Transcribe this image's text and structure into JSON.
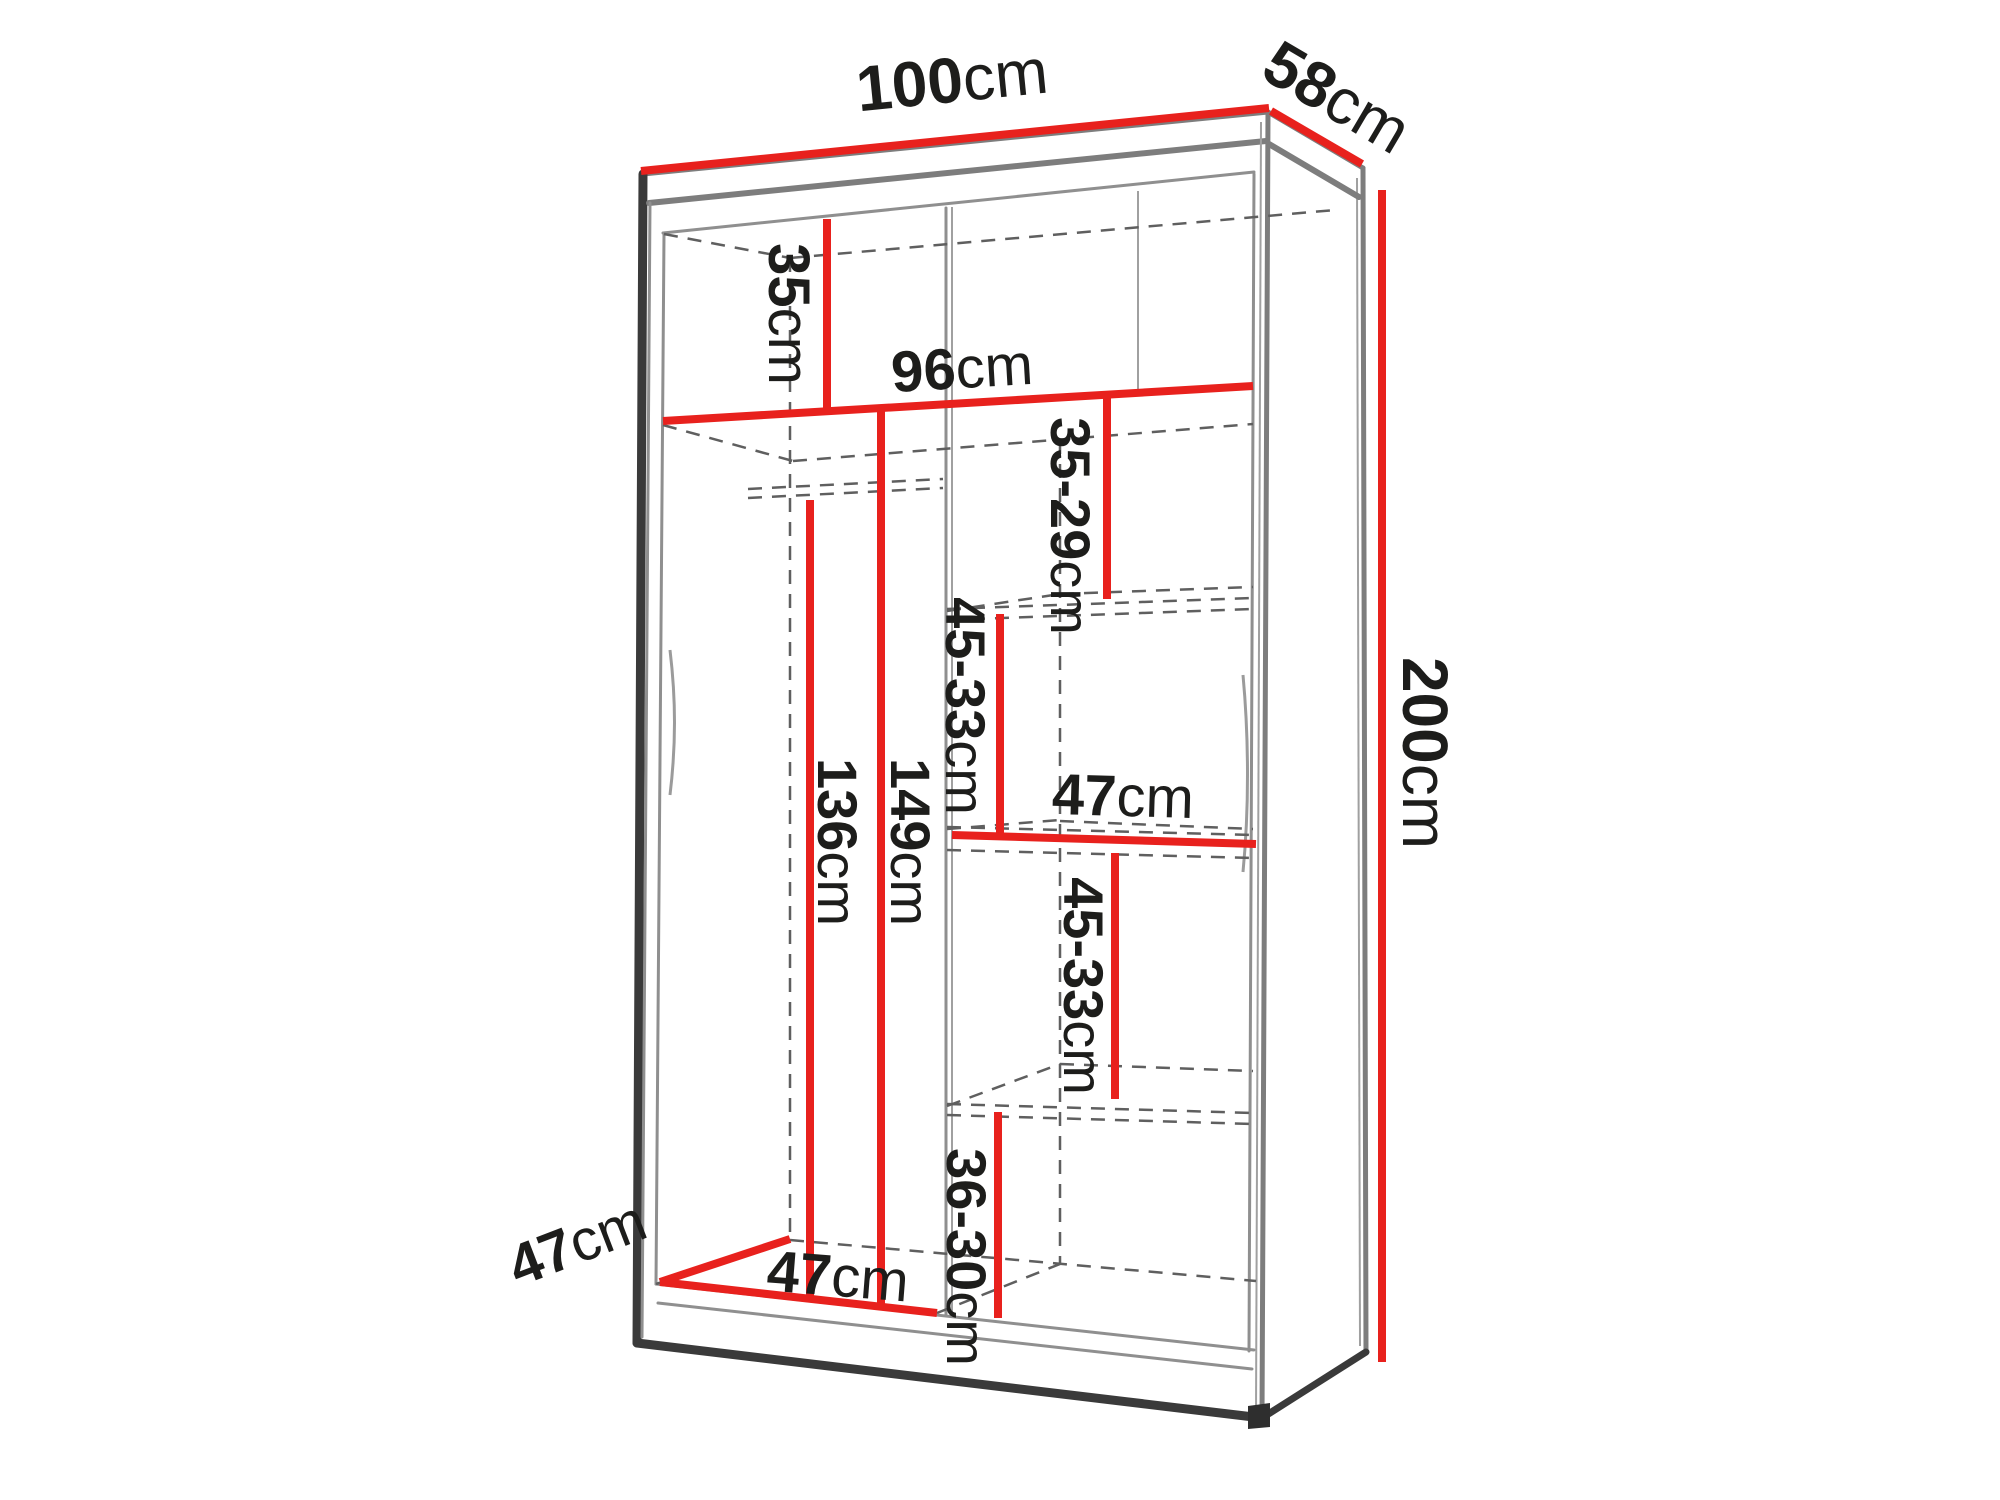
{
  "colors": {
    "dimension_red": "#e8211d",
    "line_dark": "#3a3a3a",
    "line_gray": "#7d7d7d",
    "text_dark": "#1d1d1b",
    "background": "#ffffff"
  },
  "dimensions": {
    "overall_width": {
      "value": "100",
      "unit": "cm"
    },
    "overall_depth": {
      "value": "58",
      "unit": "cm"
    },
    "overall_height": {
      "value": "200",
      "unit": "cm"
    },
    "top_compartment_height": {
      "value": "35",
      "unit": "cm"
    },
    "interior_width": {
      "value": "96",
      "unit": "cm"
    },
    "gap_top_right": {
      "value": "35-29",
      "unit": "cm"
    },
    "gap_upper_right": {
      "value": "45-33",
      "unit": "cm"
    },
    "shelf_width_right": {
      "value": "47",
      "unit": "cm"
    },
    "gap_lower_right": {
      "value": "45-33",
      "unit": "cm"
    },
    "gap_bottom_right": {
      "value": "36-30",
      "unit": "cm"
    },
    "hanging_space_height": {
      "value": "136",
      "unit": "cm"
    },
    "left_section_height": {
      "value": "149",
      "unit": "cm"
    },
    "interior_depth": {
      "value": "47",
      "unit": "cm"
    },
    "left_section_width": {
      "value": "47",
      "unit": "cm"
    }
  }
}
